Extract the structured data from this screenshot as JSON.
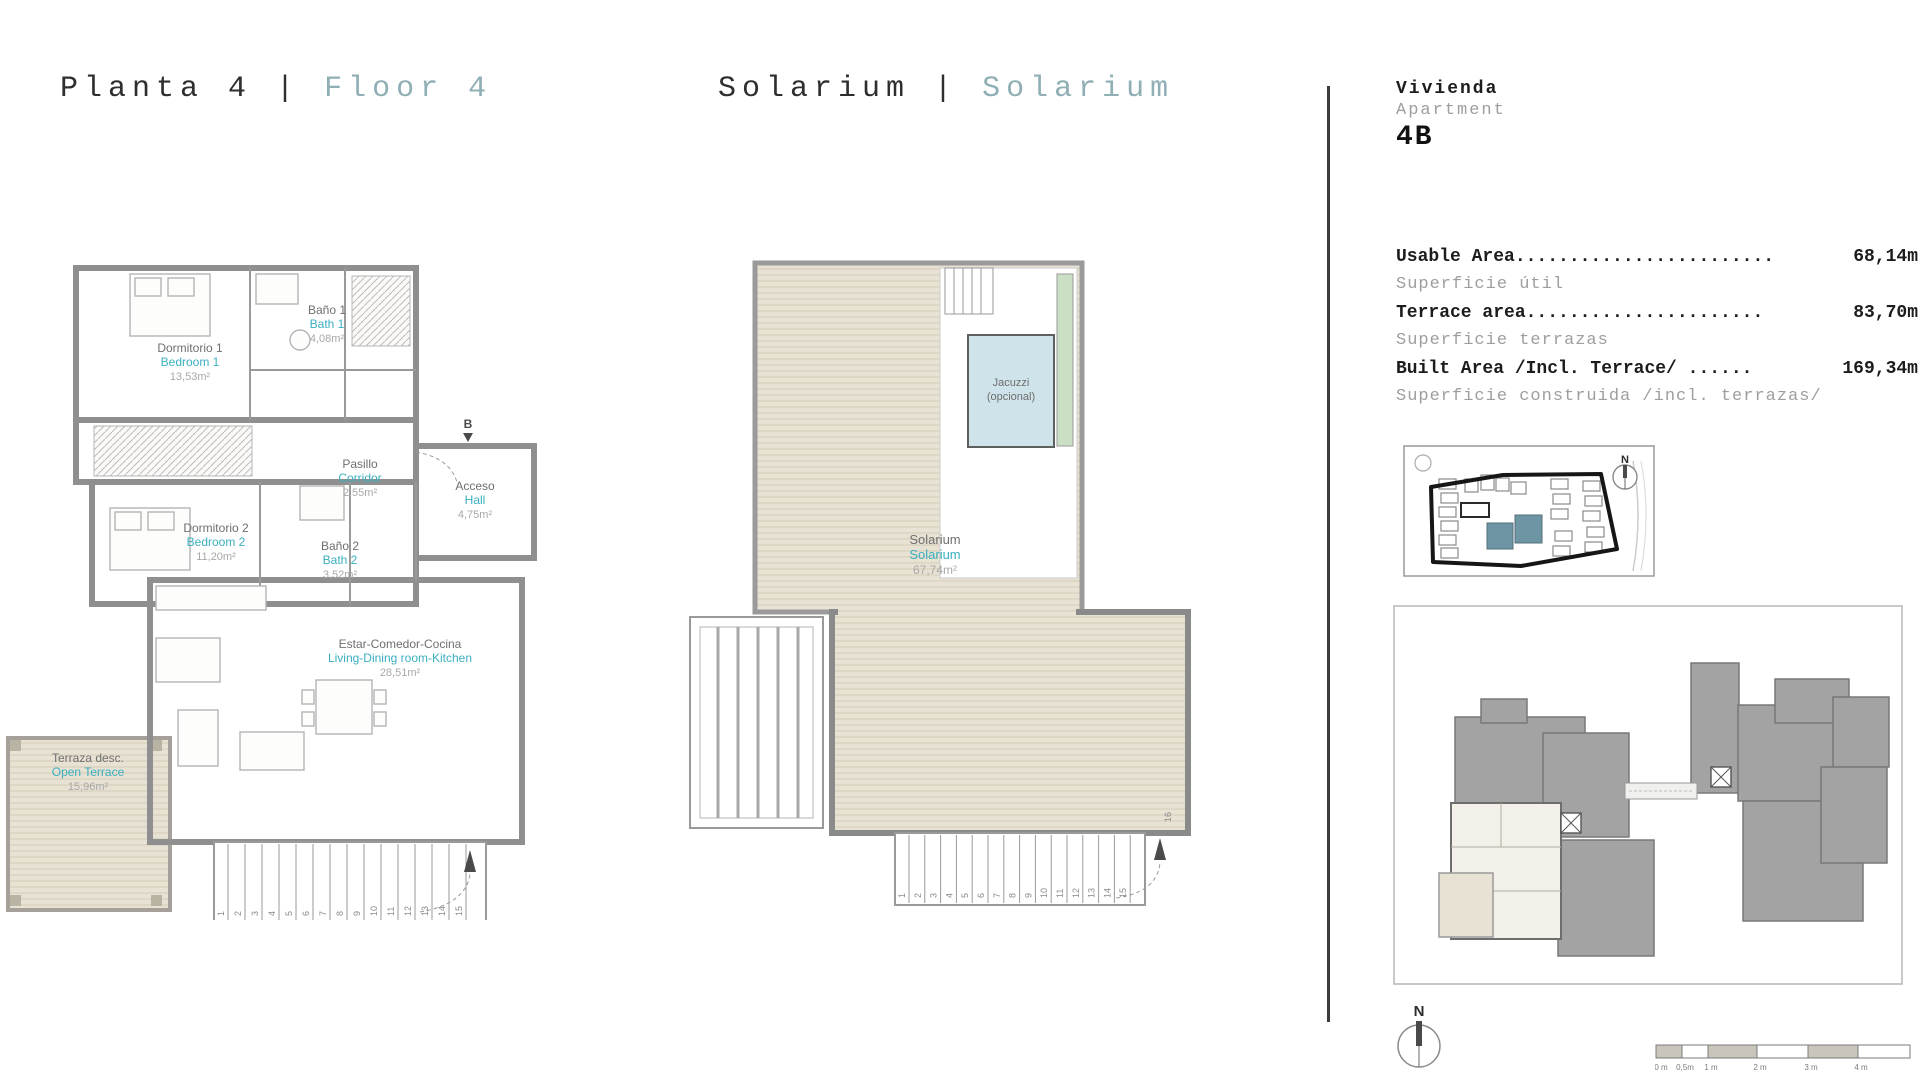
{
  "titles": {
    "left_primary": "Planta 4",
    "left_sep": "|",
    "left_secondary": "Floor 4",
    "mid_primary": "Solarium",
    "mid_sep": "|",
    "mid_secondary": "Solarium"
  },
  "apartment": {
    "label_es": "Vivienda",
    "label_en": "Apartment",
    "unit": "4B"
  },
  "areas": {
    "rows": [
      {
        "label": "Usable Area........................",
        "value": "68,14m",
        "sub": "Superficie útil"
      },
      {
        "label": "Terrace area......................",
        "value": "83,70m",
        "sub": "Superficie terrazas"
      },
      {
        "label": "Built Area /Incl. Terrace/ ......",
        "value": "169,34m",
        "sub": "Superficie construida /incl. terrazas/"
      }
    ]
  },
  "plan_left": {
    "rooms": [
      {
        "es": "Dormitorio 1",
        "en": "Bedroom 1",
        "area": "13,53m²"
      },
      {
        "es": "Baño 1",
        "en": "Bath 1",
        "area": "4,08m²"
      },
      {
        "es": "Pasillo",
        "en": "Corridor",
        "area": "2,55m²"
      },
      {
        "es": "Acceso",
        "en": "Hall",
        "area": "4,75m²"
      },
      {
        "es": "Dormitorio 2",
        "en": "Bedroom 2",
        "area": "11,20m²"
      },
      {
        "es": "Baño 2",
        "en": "Bath 2",
        "area": "3,52m²"
      },
      {
        "es": "Estar-Comedor-Cocina",
        "en": "Living-Dining room-Kitchen",
        "area": "28,51m²"
      },
      {
        "es": "Terraza desc.",
        "en": "Open Terrace",
        "area": "15,96m²"
      }
    ],
    "section_marker": "B",
    "stair_numbers": [
      "1",
      "2",
      "3",
      "4",
      "5",
      "6",
      "7",
      "8",
      "9",
      "10",
      "11",
      "12",
      "13",
      "14",
      "15"
    ]
  },
  "plan_solarium": {
    "room": {
      "es": "Solarium",
      "en": "Solarium",
      "area": "67,74m²"
    },
    "jacuzzi_line1": "Jacuzzi",
    "jacuzzi_line2": "(opcional)",
    "stair_numbers": [
      "1",
      "2",
      "3",
      "4",
      "5",
      "6",
      "7",
      "8",
      "9",
      "10",
      "11",
      "12",
      "13",
      "14",
      "15"
    ],
    "last_step": "16"
  },
  "site_map": {
    "compass_n": "N"
  },
  "footer": {
    "compass_n": "N",
    "scale_labels": [
      "0 m",
      "0,5m",
      "1 m",
      "2 m",
      "3 m",
      "4 m"
    ]
  },
  "colors": {
    "accent_teal": "#3aafc0",
    "title_teal": "#8fafb5",
    "deck_beige": "#e8e2d4",
    "jacuzzi_blue": "#cfe3ea",
    "green_strip": "#cadfc3",
    "site_highlight": "#6e95a3",
    "wall_gray": "#8f8f8f",
    "text_gray": "#9e9e9e"
  }
}
